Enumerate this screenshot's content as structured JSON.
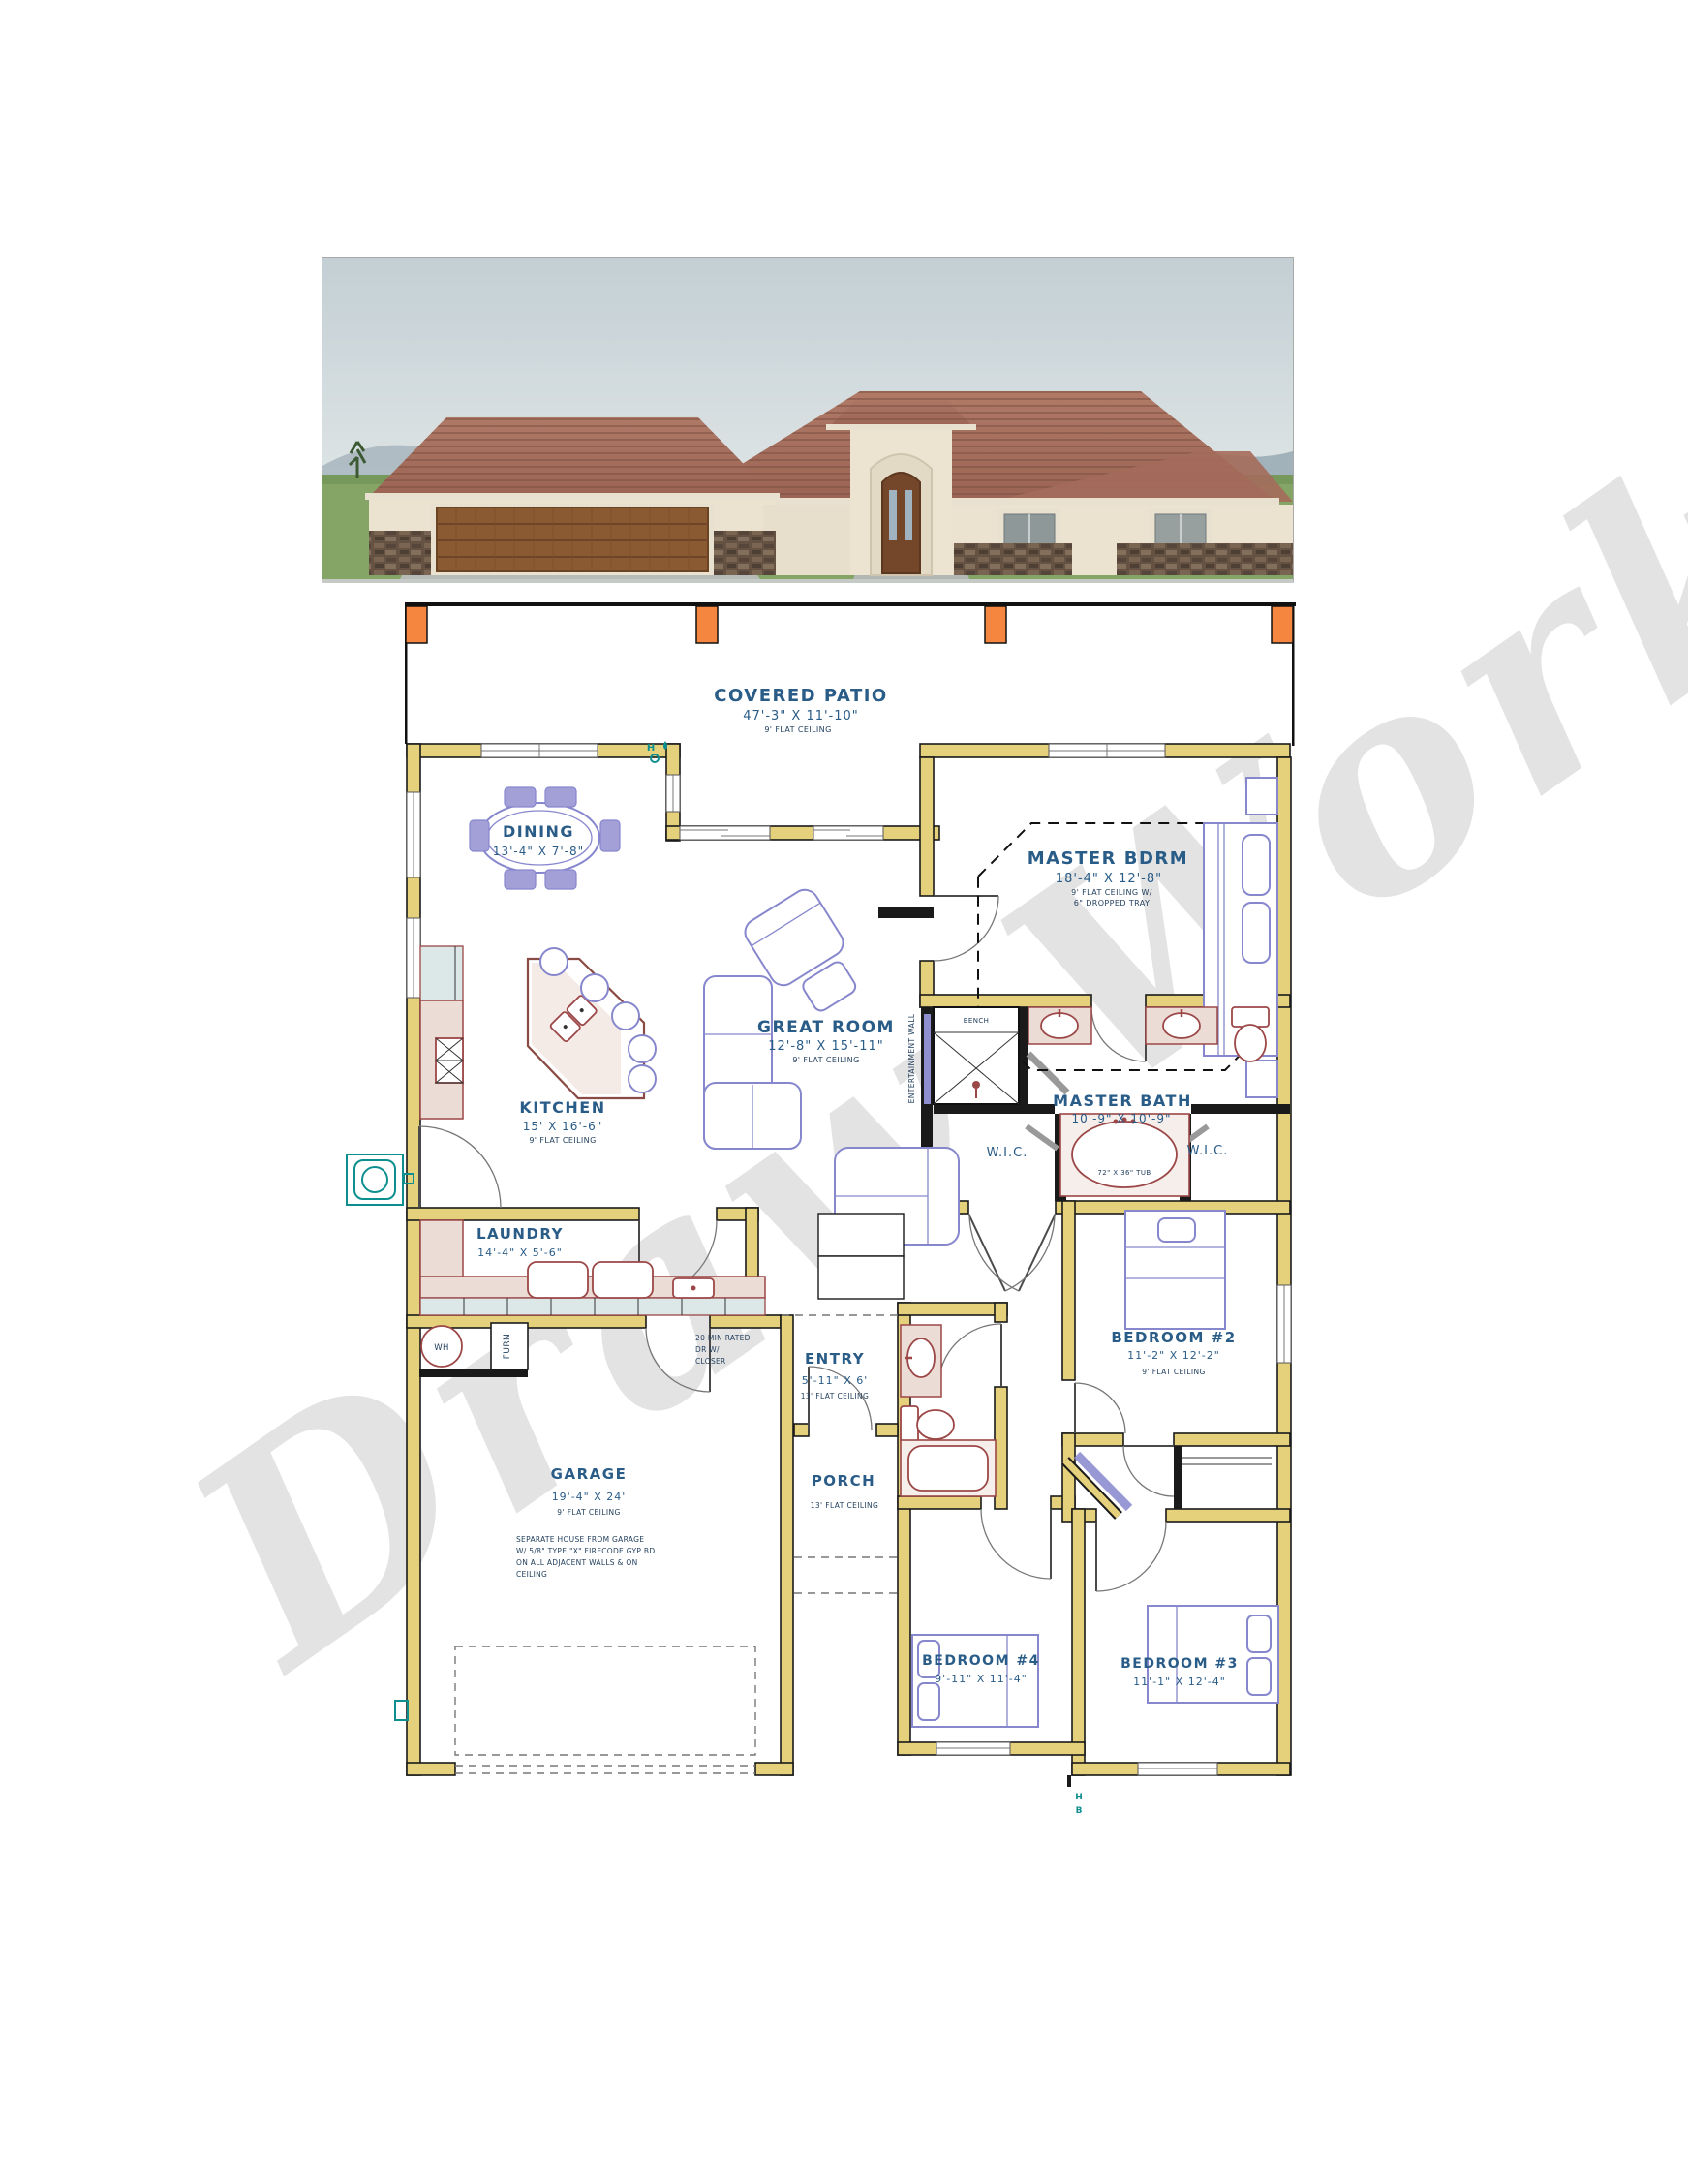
{
  "watermark": {
    "text": "Draw Works"
  },
  "plan": {
    "rooms": [
      {
        "id": "covered_patio",
        "name": "COVERED PATIO",
        "dims": "47'-3\" X 11'-10\"",
        "ceil": "9' FLAT CEILING"
      },
      {
        "id": "dining",
        "name": "DINING",
        "dims": "13'-4\" X 7'-8\""
      },
      {
        "id": "master_bdrm",
        "name": "MASTER BDRM",
        "dims": "18'-4\" X 12'-8\"",
        "ceil": "9' FLAT CEILING W/",
        "ceil2": "6\" DROPPED TRAY"
      },
      {
        "id": "great_room",
        "name": "GREAT ROOM",
        "dims": "12'-8\" X 15'-11\"",
        "ceil": "9' FLAT CEILING"
      },
      {
        "id": "kitchen",
        "name": "KITCHEN",
        "dims": "15' X 16'-6\"",
        "ceil": "9' FLAT CEILING"
      },
      {
        "id": "master_bath",
        "name": "MASTER BATH",
        "dims": "10'-9\" X 10'-9\""
      },
      {
        "id": "laundry",
        "name": "LAUNDRY",
        "dims": "14'-4\" X 5'-6\""
      },
      {
        "id": "entry",
        "name": "ENTRY",
        "dims": "5'-11\" X 6'",
        "ceil": "13' FLAT CEILING"
      },
      {
        "id": "porch",
        "name": "PORCH",
        "ceil": "13' FLAT CEILING"
      },
      {
        "id": "bedroom2",
        "name": "BEDROOM #2",
        "dims": "11'-2\" X 12'-2\"",
        "ceil": "9' FLAT CEILING"
      },
      {
        "id": "garage",
        "name": "GARAGE",
        "dims": "19'-4\" X 24'",
        "ceil": "9' FLAT CEILING"
      },
      {
        "id": "bedroom4",
        "name": "BEDROOM #4",
        "dims": "9'-11\" X 11'-4\""
      },
      {
        "id": "bedroom3",
        "name": "BEDROOM #3",
        "dims": "11'-1\" X 12'-4\""
      }
    ],
    "labels": {
      "wic_left": "W.I.C.",
      "wic_right": "W.I.C.",
      "bench": "BENCH",
      "tub": "72\" X 36\" TUB",
      "entertainment_wall": "ENTERTAINMENT WALL",
      "wh": "WH",
      "furn": "FURN",
      "hose_h": "H",
      "hose_b": "B"
    },
    "door_note": [
      "20 MIN RATED",
      "DR W/",
      "CLOSER"
    ],
    "garage_note": [
      "SEPARATE HOUSE FROM GARAGE",
      "W/ 5/8\" TYPE \"X\" FIRECODE GYP BD",
      "ON ALL ADJACENT WALLS & ON",
      "CEILING"
    ],
    "colors": {
      "label_blue": "#2a5c88",
      "wall_yellow": "#e5d07c",
      "post_orange": "#f4863f",
      "furniture_purple": "#8787cd",
      "fixture_maroon": "#9c4747",
      "utility_teal": "#0e8f8f"
    }
  }
}
